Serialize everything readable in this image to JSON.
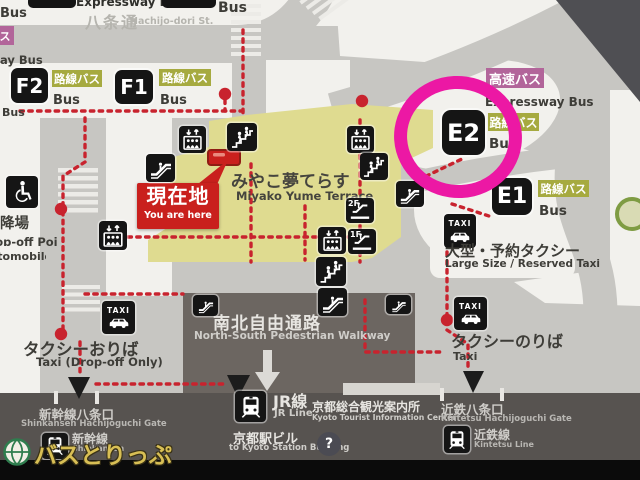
{
  "top": {
    "expressway_bus": "Expressway Bus",
    "bus": "Bus",
    "street_ja": "八条通",
    "street_en": "Hachijo-dori St.",
    "edge_bus_top": "Bus",
    "edge_katakana": "ス",
    "edge_ay_bus": "ay Bus",
    "edge_bus_low": "Bus"
  },
  "stops": {
    "f2": {
      "id": "F2",
      "tag": "路線バス",
      "en": "Bus"
    },
    "f1": {
      "id": "F1",
      "tag": "路線バス",
      "en": "Bus"
    },
    "e2": {
      "id": "E2",
      "tag": "路線バス",
      "en": "Bus",
      "express_tag": "高速バス",
      "express_en": "Expressway Bus"
    },
    "e1": {
      "id": "E1",
      "tag": "路線バス",
      "en": "Bus"
    }
  },
  "current_location": {
    "ja": "現在地",
    "en": "You are here"
  },
  "terrace": {
    "ja": "みやこ夢てらす",
    "en": "Miyako Yume Terrace"
  },
  "dropoff_point": {
    "ja": "降場",
    "en_line1": "Drop-off Point",
    "en_line2": "(automobile)"
  },
  "taxi": {
    "sign": "TAXI",
    "dropoff_ja": "タクシーおりば",
    "dropoff_en": "Taxi (Drop-off Only)",
    "stand_ja": "タクシーのりば",
    "stand_en": "Taxi",
    "reserved_ja": "大型・予約タクシー",
    "reserved_en": "Large Size / Reserved Taxi"
  },
  "walkway": {
    "ja": "南北自由通路",
    "en": "North-South Pedestrian Walkway"
  },
  "stations": {
    "jr_ja": "JR線",
    "jr_en": "JR Line",
    "info_ja": "京都総合観光案内所",
    "info_en": "Kyoto Tourist Information Center",
    "building_ja": "京都駅ビル",
    "building_en": "to Kyoto Station Building",
    "shinkansen_gate_ja": "新幹線八条口",
    "shinkansen_gate_en": "Shinkansen Hachijoguchi Gate",
    "shinkansen_ja": "新幹線",
    "shinkansen_en": "Shinkansen",
    "kintetsu_gate_ja": "近鉄八条口",
    "kintetsu_gate_en": "Kintetsu Hachijoguchi Gate",
    "kintetsu_ja": "近鉄線",
    "kintetsu_en": "Kintetsu Line"
  },
  "floors": {
    "f2": "2F",
    "f1": "1F"
  },
  "info_mark": "?",
  "watermark": "バスとりっぷ",
  "icons": [
    "wheelchair-icon",
    "elevator-icon",
    "stairs-icon",
    "escalator-icon",
    "taxi-icon",
    "train-icon",
    "info-icon",
    "globe-icon",
    "you-are-here-marker",
    "route-arrow",
    "highlight-circle"
  ],
  "colors": {
    "highlight": "#ec18a4",
    "route_red": "#c8232e",
    "terrace_yellow": "#dfdb90",
    "local_bus_tag": "#a6aa40",
    "express_bus_tag": "#b2659a",
    "here_red": "#c9201d",
    "walkway_dark": "#6c6661"
  }
}
